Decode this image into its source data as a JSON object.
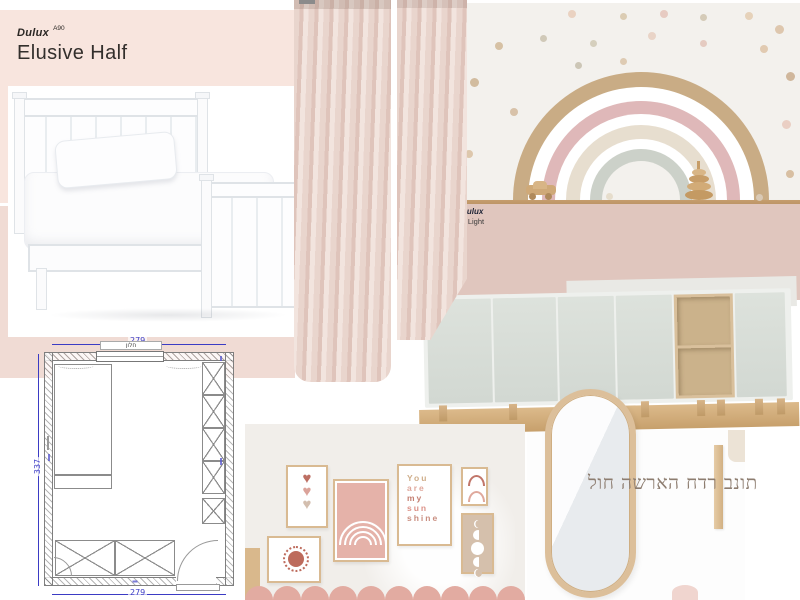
{
  "board_title": {
    "text": "לוח השראה חדר בנות",
    "color": "#8d7d70"
  },
  "paint_swatches": {
    "elusive_half": {
      "brand": "Dulux",
      "code": "A90",
      "name": "Elusive Half",
      "hex": "#f8e5de"
    },
    "left_lower": {
      "hex": "#f0dbd4"
    },
    "right_rose": {
      "brand": "dulux",
      "name": "c Light",
      "hex": "#e0c6be"
    }
  },
  "floor_plan": {
    "dim_top": "279",
    "dim_bottom": "279",
    "dim_left": "337",
    "window_label": "חלון",
    "dim_color": "#3b3bc4"
  },
  "rainbow_decal": {
    "background": "#f3f1ed",
    "shelf_color": "#c59d6e",
    "arc_colors": [
      "#c9ac85",
      "#ffffff",
      "#dfb8b9",
      "#ffffff",
      "#e7decf",
      "#ffffff",
      "#ccd1c9",
      "#f3f1ed"
    ],
    "arc_sizes": [
      256,
      226,
      198,
      172,
      150,
      122,
      102,
      78
    ],
    "dots": [
      {
        "x": 112,
        "y": 7,
        "s": 8,
        "c": "#e8cdb9"
      },
      {
        "x": 164,
        "y": 10,
        "s": 7,
        "c": "#d6c6a8"
      },
      {
        "x": 204,
        "y": 7,
        "s": 8,
        "c": "#e4c4ba"
      },
      {
        "x": 244,
        "y": 11,
        "s": 7,
        "c": "#cfc4ae"
      },
      {
        "x": 289,
        "y": 9,
        "s": 8,
        "c": "#e3cdb0"
      },
      {
        "x": 319,
        "y": 22,
        "s": 9,
        "c": "#d9bfa2"
      },
      {
        "x": 39,
        "y": 39,
        "s": 8,
        "c": "#d0b896"
      },
      {
        "x": 84,
        "y": 32,
        "s": 7,
        "c": "#c9c2ae"
      },
      {
        "x": 134,
        "y": 37,
        "s": 7,
        "c": "#cfc9b4"
      },
      {
        "x": 192,
        "y": 29,
        "s": 8,
        "c": "#e6cfc0"
      },
      {
        "x": 244,
        "y": 37,
        "s": 7,
        "c": "#e2c4b8"
      },
      {
        "x": 304,
        "y": 42,
        "s": 8,
        "c": "#ddc3a6"
      },
      {
        "x": 14,
        "y": 75,
        "s": 9,
        "c": "#cbb391"
      },
      {
        "x": 119,
        "y": 59,
        "s": 7,
        "c": "#c4beac"
      },
      {
        "x": 164,
        "y": 55,
        "s": 7,
        "c": "#d9c4a8"
      },
      {
        "x": 330,
        "y": 69,
        "s": 9,
        "c": "#c9ad8d"
      },
      {
        "x": 54,
        "y": 105,
        "s": 8,
        "c": "#d2ba9c"
      },
      {
        "x": 326,
        "y": 117,
        "s": 9,
        "c": "#e7c9bc"
      },
      {
        "x": 9,
        "y": 147,
        "s": 8,
        "c": "#d8bfa0"
      },
      {
        "x": 330,
        "y": 167,
        "s": 8,
        "c": "#d2b694"
      }
    ]
  },
  "gallery": {
    "background": "#f1eeea",
    "scallop_color": "#e2aba1",
    "frame_color": "#d9ba92",
    "prints": {
      "hearts": {
        "colors": [
          "#bd6f63",
          "#dba39a",
          "#d3beae"
        ]
      },
      "sun": {
        "color": "#bd6b5c"
      },
      "rainbow": {
        "background": "#e5b2a9",
        "line": "#ffffff",
        "arc_sizes": [
          48,
          38,
          28,
          18
        ]
      },
      "sunshine": {
        "lines": [
          {
            "text": "You",
            "color": "#cfae8a"
          },
          {
            "text": "are",
            "color": "#e0a89c"
          },
          {
            "text": "my",
            "color": "#c47f71"
          },
          {
            "text": "sun",
            "color": "#dc9288"
          },
          {
            "text": "shine",
            "color": "#c98e80"
          }
        ]
      },
      "arches": {
        "colors": [
          "#c1766a",
          "#dfa89c"
        ]
      },
      "moons": {
        "background": "#d5c0ac",
        "phases": [
          {
            "shape": "crescent",
            "size": 8
          },
          {
            "shape": "gibbous",
            "size": 10
          },
          {
            "shape": "full",
            "size": 13
          },
          {
            "shape": "gibbous",
            "size": 10
          },
          {
            "shape": "crescent",
            "size": 8
          }
        ]
      }
    }
  },
  "cabinet": {
    "door_top": "#dde2dc",
    "door_bottom": "#d2d8d2",
    "wood": "#d9c09c",
    "leg_positions": [
      14,
      84,
      148,
      216,
      272,
      292,
      330,
      352
    ]
  },
  "mirror": {
    "frame": "#dcbf9a"
  },
  "curtains": {
    "base": "#e9d5cd",
    "shade": "#dfc4bb",
    "light": "#f2e4de"
  },
  "bed": {
    "outline": "#dfe3e7"
  }
}
